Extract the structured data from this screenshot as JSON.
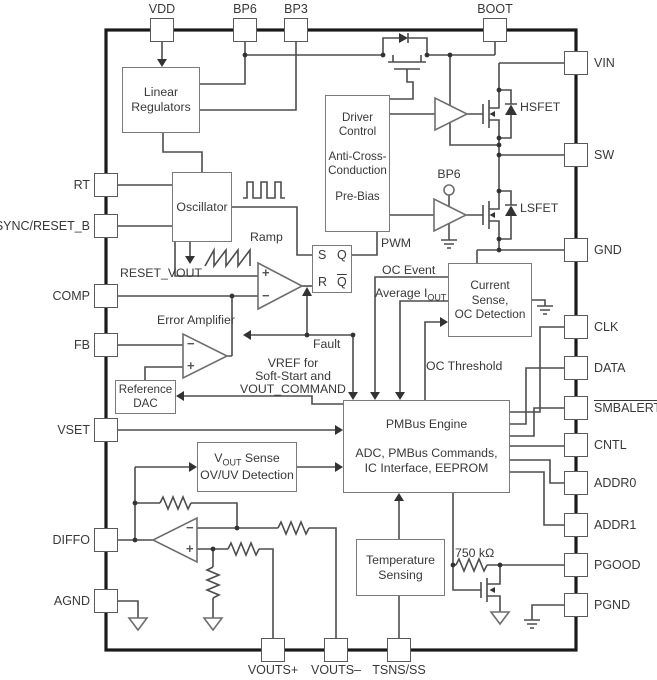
{
  "pins": {
    "top": [
      {
        "label": "VDD"
      },
      {
        "label": "BP6"
      },
      {
        "label": "BP3"
      },
      {
        "label": "BOOT"
      }
    ],
    "left": [
      {
        "label": "RT"
      },
      {
        "label": "SYNC/RESET_B"
      },
      {
        "label": "COMP"
      },
      {
        "label": "FB"
      },
      {
        "label": "VSET"
      },
      {
        "label": "DIFFO"
      },
      {
        "label": "AGND"
      }
    ],
    "right": [
      {
        "label": "VIN"
      },
      {
        "label": "SW"
      },
      {
        "label": "GND"
      },
      {
        "label": "CLK"
      },
      {
        "label": "DATA"
      },
      {
        "label": "SMBALERT"
      },
      {
        "label": "CNTL"
      },
      {
        "label": "ADDR0"
      },
      {
        "label": "ADDR1"
      },
      {
        "label": "PGOOD"
      },
      {
        "label": "PGND"
      }
    ],
    "bottom": [
      {
        "label": "VOUTS+"
      },
      {
        "label": "VOUTS–"
      },
      {
        "label": "TSNS/SS"
      }
    ]
  },
  "blocks": {
    "linear_regulators": {
      "line1": "Linear",
      "line2": "Regulators"
    },
    "oscillator": {
      "line1": "Oscillator"
    },
    "driver_control": {
      "line1": "Driver",
      "line2": "Control",
      "line3": "Anti-Cross-",
      "line4": "Conduction",
      "line5": "Pre-Bias"
    },
    "sr_latch": {
      "s": "S",
      "q": "Q",
      "r": "R",
      "qbar": "Q"
    },
    "current_sense": {
      "line1": "Current",
      "line2": "Sense,",
      "line3": "OC Detection"
    },
    "pmbus": {
      "line1": "PMBus Engine",
      "line2": "ADC, PMBus Commands,",
      "line3": "IC Interface, EEPROM"
    },
    "reference_dac": {
      "line1": "Reference",
      "line2": "DAC"
    },
    "vout_sense": {
      "v": "V",
      "sub": "OUT",
      "rest": " Sense",
      "line2": "OV/UV Detection"
    },
    "temp_sensing": {
      "line1": "Temperature",
      "line2": "Sensing"
    }
  },
  "labels": {
    "reset_vout": "RESET_VOUT",
    "ramp": "Ramp",
    "pwm": "PWM",
    "oc_event": "OC Event",
    "avg_i": "Average I",
    "avg_i_sub": "OUT",
    "oc_threshold": "OC Threshold",
    "fault": "Fault",
    "error_amplifier": "Error Amplifier",
    "vref1": "VREF for",
    "vref2": "Soft-Start and",
    "vref3": "VOUT_COMMAND",
    "hsfet": "HSFET",
    "lsfet": "LSFET",
    "bp6_driver": "BP6",
    "r750": "750 kΩ",
    "plus": "+",
    "minus": "−"
  },
  "colors": {
    "wire": "#4d4d4d",
    "chip_outline": "#1a1a1a",
    "block_outline": "#7a7a7a",
    "text": "#383838"
  }
}
